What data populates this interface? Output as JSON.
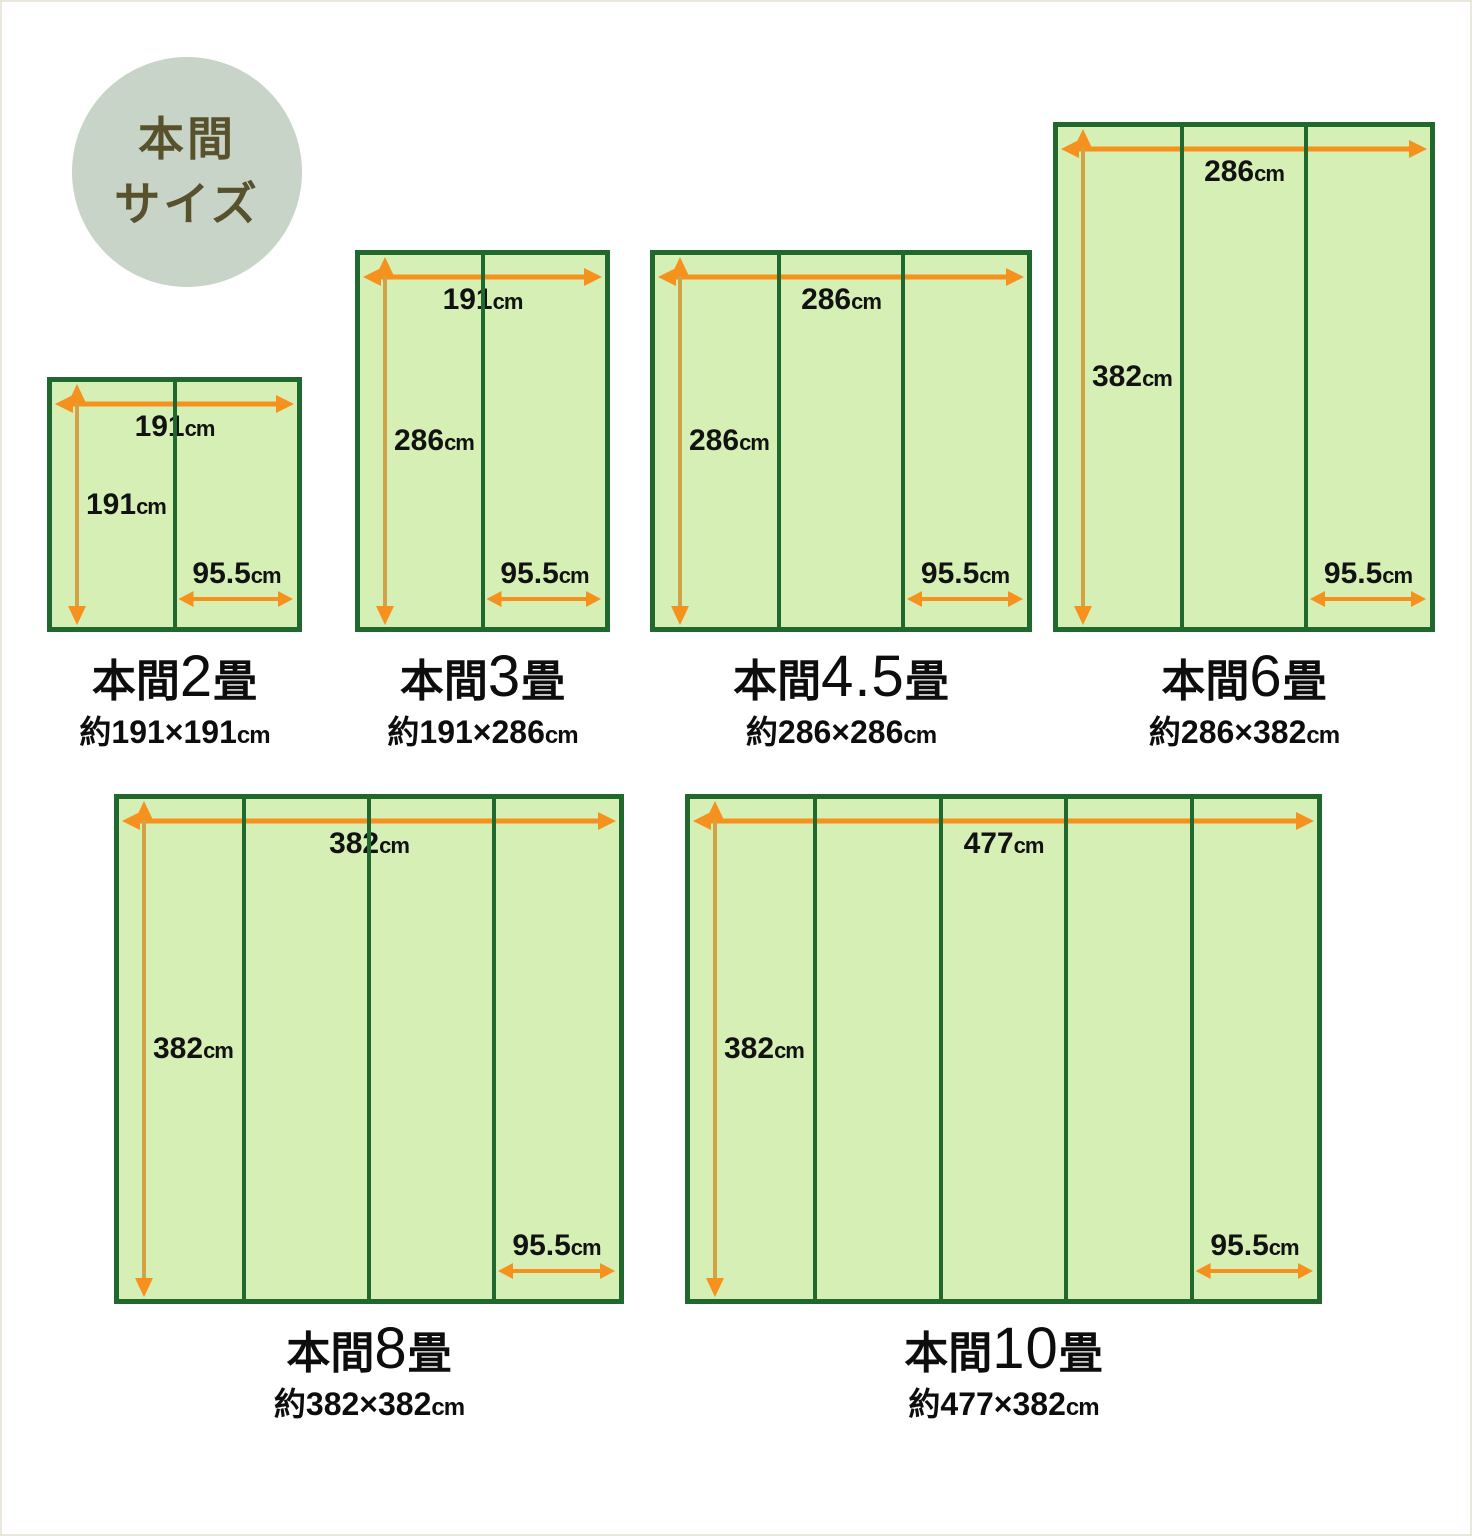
{
  "page": {
    "background": "#ffffff",
    "frame_color": "#ebe7dd"
  },
  "badge": {
    "line1": "本間",
    "line2": "サイズ",
    "bg_color": "#c8d4c7",
    "text_color": "#57522d"
  },
  "colors": {
    "mat_fill": "#d6efb4",
    "mat_border": "#20682e",
    "arrow_orange": "#f6911d",
    "arrow_vertical_line": "#d2a246",
    "label_text": "#121212"
  },
  "scale_px_per_cm": 1.335,
  "unit": "cm",
  "mat_width_value": "95.5",
  "panels": [
    {
      "title_prefix": "本間",
      "title_number": "2",
      "title_suffix": "畳",
      "subtitle_value": "約191×191",
      "width_cm": 191,
      "height_cm": 191,
      "width_value": "191",
      "height_value": "191",
      "mat_columns": 2,
      "x": 45,
      "y": 375
    },
    {
      "title_prefix": "本間",
      "title_number": "3",
      "title_suffix": "畳",
      "subtitle_value": "約191×286",
      "width_cm": 191,
      "height_cm": 286,
      "width_value": "191",
      "height_value": "286",
      "mat_columns": 2,
      "x": 353,
      "y": 248
    },
    {
      "title_prefix": "本間",
      "title_number": "4.5",
      "title_suffix": "畳",
      "subtitle_value": "約286×286",
      "width_cm": 286,
      "height_cm": 286,
      "width_value": "286",
      "height_value": "286",
      "mat_columns": 3,
      "x": 648,
      "y": 248
    },
    {
      "title_prefix": "本間",
      "title_number": "6",
      "title_suffix": "畳",
      "subtitle_value": "約286×382",
      "width_cm": 286,
      "height_cm": 382,
      "width_value": "286",
      "height_value": "382",
      "mat_columns": 3,
      "x": 1051,
      "y": 120
    },
    {
      "title_prefix": "本間",
      "title_number": "8",
      "title_suffix": "畳",
      "subtitle_value": "約382×382",
      "width_cm": 382,
      "height_cm": 382,
      "width_value": "382",
      "height_value": "382",
      "mat_columns": 4,
      "x": 112,
      "y": 792
    },
    {
      "title_prefix": "本間",
      "title_number": "10",
      "title_suffix": "畳",
      "subtitle_value": "約477×382",
      "width_cm": 477,
      "height_cm": 382,
      "width_value": "477",
      "height_value": "382",
      "mat_columns": 5,
      "x": 683,
      "y": 792
    }
  ]
}
